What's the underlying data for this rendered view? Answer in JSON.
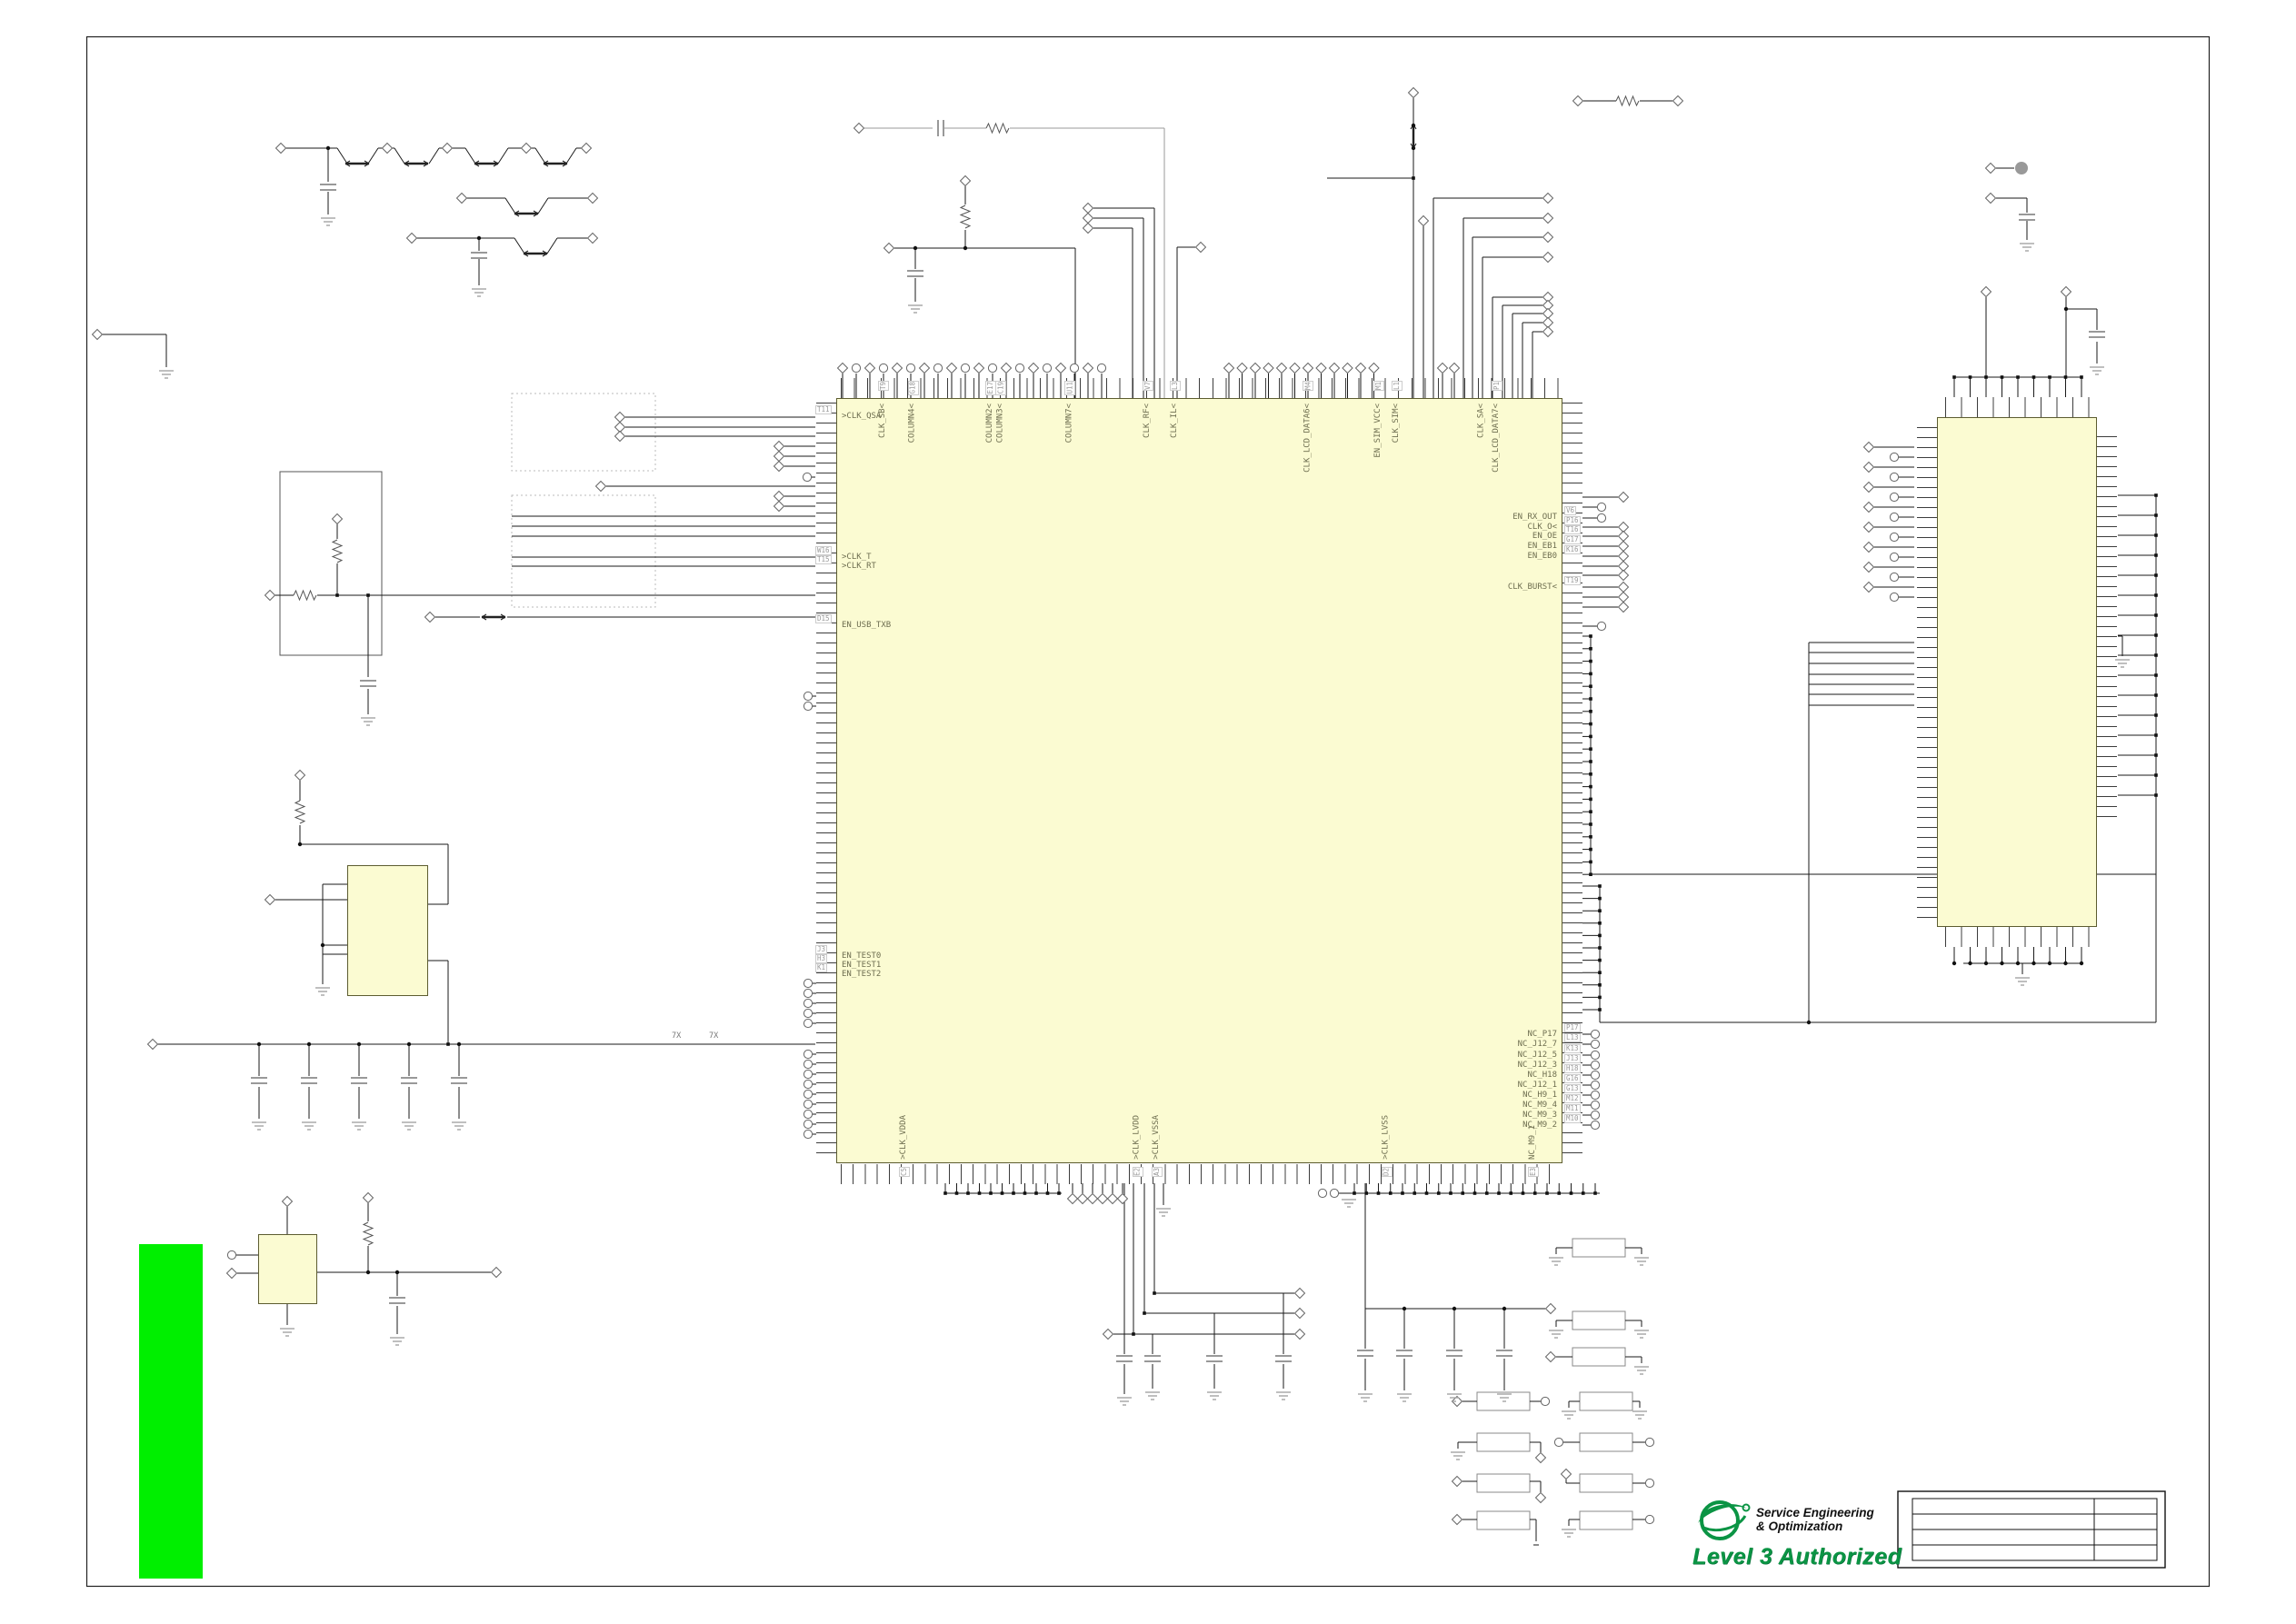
{
  "sheet": {
    "bg": "#ffffff",
    "border_color": "#1a1a1a"
  },
  "colors": {
    "ic_fill": "#fbfbd2",
    "ic_border": "#5c5c30",
    "green_bar": "#00ef00",
    "logo_green": "#0b9444",
    "wire": "#1a1a1a",
    "wire_gray": "#9a9a9a",
    "label_text": "#6e6e50",
    "pin_number_text": "#999999"
  },
  "main_ic": {
    "left_pins": [
      {
        "label": ">CLK_QSA",
        "pin": "T11",
        "f": 0.024
      },
      {
        "label": ">CLK_T",
        "pin": "W16",
        "f": 0.208
      },
      {
        "label": ">CLK_RT",
        "pin": "T15",
        "f": 0.22
      },
      {
        "label": "EN_USB_TXB",
        "pin": "D15",
        "f": 0.297
      },
      {
        "label": "EN_TEST0",
        "pin": "J3",
        "f": 0.729
      },
      {
        "label": "EN_TEST1",
        "pin": "H3",
        "f": 0.741
      },
      {
        "label": "EN_TEST2",
        "pin": "K1",
        "f": 0.753
      }
    ],
    "top_pins": [
      {
        "label": "CLK_SB<",
        "pin": "T9",
        "f": 0.065
      },
      {
        "label": "COLUMN4<",
        "pin": "G18",
        "f": 0.106
      },
      {
        "label": "COLUMN2<",
        "pin": "E17",
        "f": 0.213
      },
      {
        "label": "COLUMN3<",
        "pin": "C19",
        "f": 0.227
      },
      {
        "label": "COLUMN7<",
        "pin": "U11",
        "f": 0.322
      },
      {
        "label": "CLK_RF<",
        "pin": "V7",
        "f": 0.429
      },
      {
        "label": "CLK_IL<",
        "pin": "L3",
        "f": 0.467
      },
      {
        "label": "CLK_LCD_DATA6<",
        "pin": "M4",
        "f": 0.65
      },
      {
        "label": "EN_SIM_VCC<",
        "pin": "M1",
        "f": 0.747
      },
      {
        "label": "CLK_SIM<",
        "pin": "L1",
        "f": 0.772
      },
      {
        "label": "CLK_SA<",
        "pin": "",
        "f": 0.889
      },
      {
        "label": "CLK_LCD_DATA7<",
        "pin": "P1",
        "f": 0.91
      }
    ],
    "right_pins": [
      {
        "label": "EN_RX_OUT",
        "pin": "V6",
        "f": 0.156
      },
      {
        "label": "CLK_O<",
        "pin": "P16",
        "f": 0.169
      },
      {
        "label": "EN_OE",
        "pin": "T16",
        "f": 0.181
      },
      {
        "label": "EN_EB1",
        "pin": "G17",
        "f": 0.194
      },
      {
        "label": "EN_EB0",
        "pin": "K16",
        "f": 0.207
      },
      {
        "label": "CLK_BURST<",
        "pin": "T19",
        "f": 0.247
      },
      {
        "label": "NC_P17",
        "pin": "P17",
        "f": 0.831
      },
      {
        "label": "NC_J12_7",
        "pin": "L13",
        "f": 0.844
      },
      {
        "label": "NC_J12_5",
        "pin": "K13",
        "f": 0.859
      },
      {
        "label": "NC_J12_3",
        "pin": "J13",
        "f": 0.872
      },
      {
        "label": "NC_H18",
        "pin": "H18",
        "f": 0.885
      },
      {
        "label": "NC_J12_1",
        "pin": "G16",
        "f": 0.898
      },
      {
        "label": "NC_H9_1",
        "pin": "G13",
        "f": 0.911
      },
      {
        "label": "NC_M9_4",
        "pin": "M12",
        "f": 0.924
      },
      {
        "label": "NC_M9_3",
        "pin": "M11",
        "f": 0.937
      },
      {
        "label": "NC_M9_2",
        "pin": "M10",
        "f": 0.95
      }
    ],
    "bottom_pins": [
      {
        "label": ">CLK_VDDA",
        "pin": "C5",
        "f": 0.094
      },
      {
        "label": ">CLK_LVDD",
        "pin": "E2",
        "f": 0.415
      },
      {
        "label": ">CLK_VSSA",
        "pin": "A3",
        "f": 0.442
      },
      {
        "label": ">CLK_LVSS",
        "pin": "D2",
        "f": 0.758
      },
      {
        "label": "NC_M9_1",
        "pin": "E3",
        "f": 0.96
      }
    ]
  },
  "rail_labels": [
    "7X",
    "7X"
  ],
  "logo": {
    "line1": "Service Engineering",
    "line2": "& Optimization",
    "line3": "Level 3 Authorized"
  },
  "title_block": {
    "rows": [
      "",
      "",
      "",
      ""
    ]
  }
}
